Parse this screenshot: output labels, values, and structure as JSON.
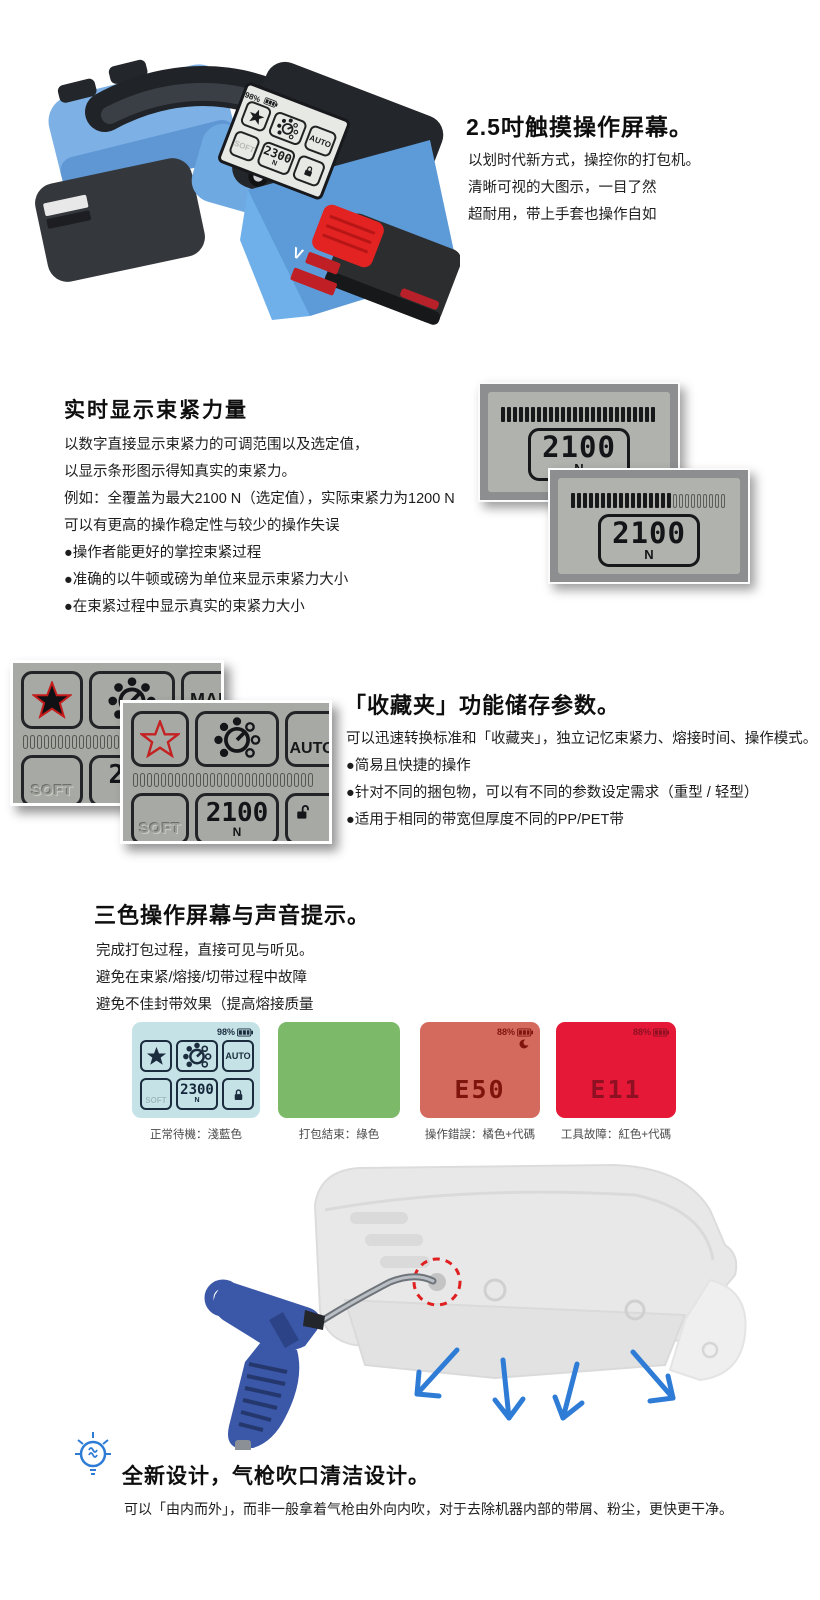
{
  "accents": {
    "machine_blue": "#6fa8e0",
    "button_red": "#e32222",
    "star_red": "#c41b1b",
    "lcd_gray": "#b0b2ad",
    "standby_blue": "#c5e2e6",
    "ok_green": "#7cb969",
    "warn_orange": "#d4695e",
    "alert_red": "#e51937",
    "arrow_blue": "#2e7cd6"
  },
  "icons": {
    "star": "★",
    "dial": "tension-dial",
    "lock_open": "open-padlock",
    "lock_closed": "closed-padlock",
    "battery": "battery-gauge",
    "bulb": "lightbulb",
    "arrow": "↘"
  },
  "hero": {
    "title": "2.5吋触摸操作屏幕。",
    "lines": [
      "以划时代新方式，操控你的打包机。",
      "清晰可视的大图示，一目了然",
      "超耐用，带上手套也操作自如"
    ],
    "label_v": "V",
    "screen": {
      "battery": "98%",
      "mode": "AUTO",
      "soft": "SOFT",
      "value": "2300",
      "unit": "N"
    }
  },
  "force": {
    "title": "实时显示束紧力量",
    "lines": [
      "以数字直接显示束紧力的可调范围以及选定值，",
      "以显示条形图示得知真实的束紧力。",
      "例如：全覆盖为最大2100 N（选定值），实际束紧力为1200 N",
      "可以有更高的操作稳定性与较少的操作失误",
      "●操作者能更好的掌控束紧过程",
      "●准确的以牛顿或磅为单位来显示束紧力大小",
      "●在束紧过程中显示真实的束紧力大小"
    ],
    "panels": [
      {
        "value": "2100",
        "unit": "N",
        "bars": {
          "filled": 30,
          "empty": 0
        }
      },
      {
        "value": "2100",
        "unit": "N",
        "bars": {
          "filled": 17,
          "empty": 13
        }
      }
    ]
  },
  "favorites": {
    "title": "「收藏夹」功能储存参数。",
    "lines": [
      "可以迅速转换标准和「收藏夹」，独立记忆束紧力、熔接时间、操作模式。",
      "●简易且快捷的操作",
      "●针对不同的捆包物，可以有不同的参数设定需求（重型 / 轻型）",
      "●适用于相同的带宽但厚度不同的PP/PET带"
    ],
    "screens": [
      {
        "mode": "MAN",
        "soft": "SOFT",
        "value": "250",
        "unit": "N",
        "star": "filled",
        "bars": {
          "filled": 0,
          "empty": 26
        }
      },
      {
        "mode": "AUTO",
        "soft": "SOFT",
        "value": "2100",
        "unit": "N",
        "star": "outline",
        "bars": {
          "filled": 0,
          "empty": 26
        }
      }
    ]
  },
  "tricolor": {
    "title": "三色操作屏幕与声音提示。",
    "lines": [
      "完成打包过程，直接可见与听见。",
      "避免在束紧/熔接/切带过程中故障",
      "避免不佳封带效果（提高熔接质量"
    ],
    "screens": [
      {
        "caption": "正常待機：淺藍色",
        "battery": "98%",
        "mode": "AUTO",
        "soft": "SOFT",
        "value": "2300",
        "unit": "N"
      },
      {
        "caption": "打包結束：綠色"
      },
      {
        "caption": "操作錯誤：橘色+代碼",
        "battery": "88%",
        "code": "E50"
      },
      {
        "caption": "工具故障：紅色+代碼",
        "battery": "88%",
        "code": "E11"
      }
    ]
  },
  "airgun": {
    "title": "全新设计，气枪吹口清洁设计。",
    "line": "可以「由内而外」，而非一般拿着气枪由外向内吹，对于去除机器内部的带屑、粉尘，更快更干净。"
  }
}
